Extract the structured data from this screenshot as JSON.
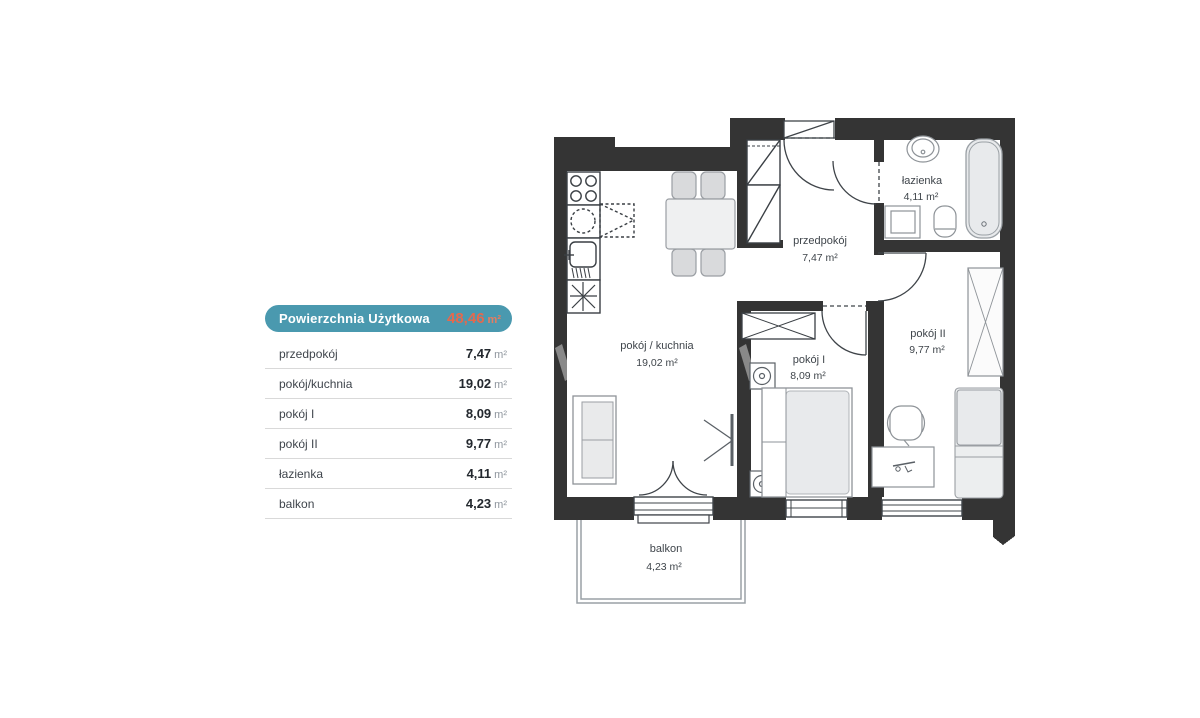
{
  "legend": {
    "header": {
      "title": "Powierzchnia Użytkowa",
      "value": "48,46",
      "unit": "m²"
    },
    "rows": [
      {
        "label": "przedpokój",
        "value": "7,47",
        "unit": "m²"
      },
      {
        "label": "pokój/kuchnia",
        "value": "19,02",
        "unit": "m²"
      },
      {
        "label": "pokój I",
        "value": "8,09",
        "unit": "m²"
      },
      {
        "label": "pokój II",
        "value": "9,77",
        "unit": "m²"
      },
      {
        "label": "łazienka",
        "value": "4,11",
        "unit": "m²"
      },
      {
        "label": "balkon",
        "value": "4,23",
        "unit": "m²"
      }
    ]
  },
  "plan": {
    "rooms": [
      {
        "name": "pokój / kuchnia",
        "area": "19,02 m²"
      },
      {
        "name": "przedpokój",
        "area": "7,47 m²"
      },
      {
        "name": "łazienka",
        "area": "4,11 m²"
      },
      {
        "name": "pokój I",
        "area": "8,09 m²"
      },
      {
        "name": "pokój II",
        "area": "9,77 m²"
      },
      {
        "name": "balkon",
        "area": "4,23 m²"
      }
    ]
  },
  "colors": {
    "accent_teal": "#4a99af",
    "accent_orange": "#e4694e",
    "wall": "#343434"
  }
}
